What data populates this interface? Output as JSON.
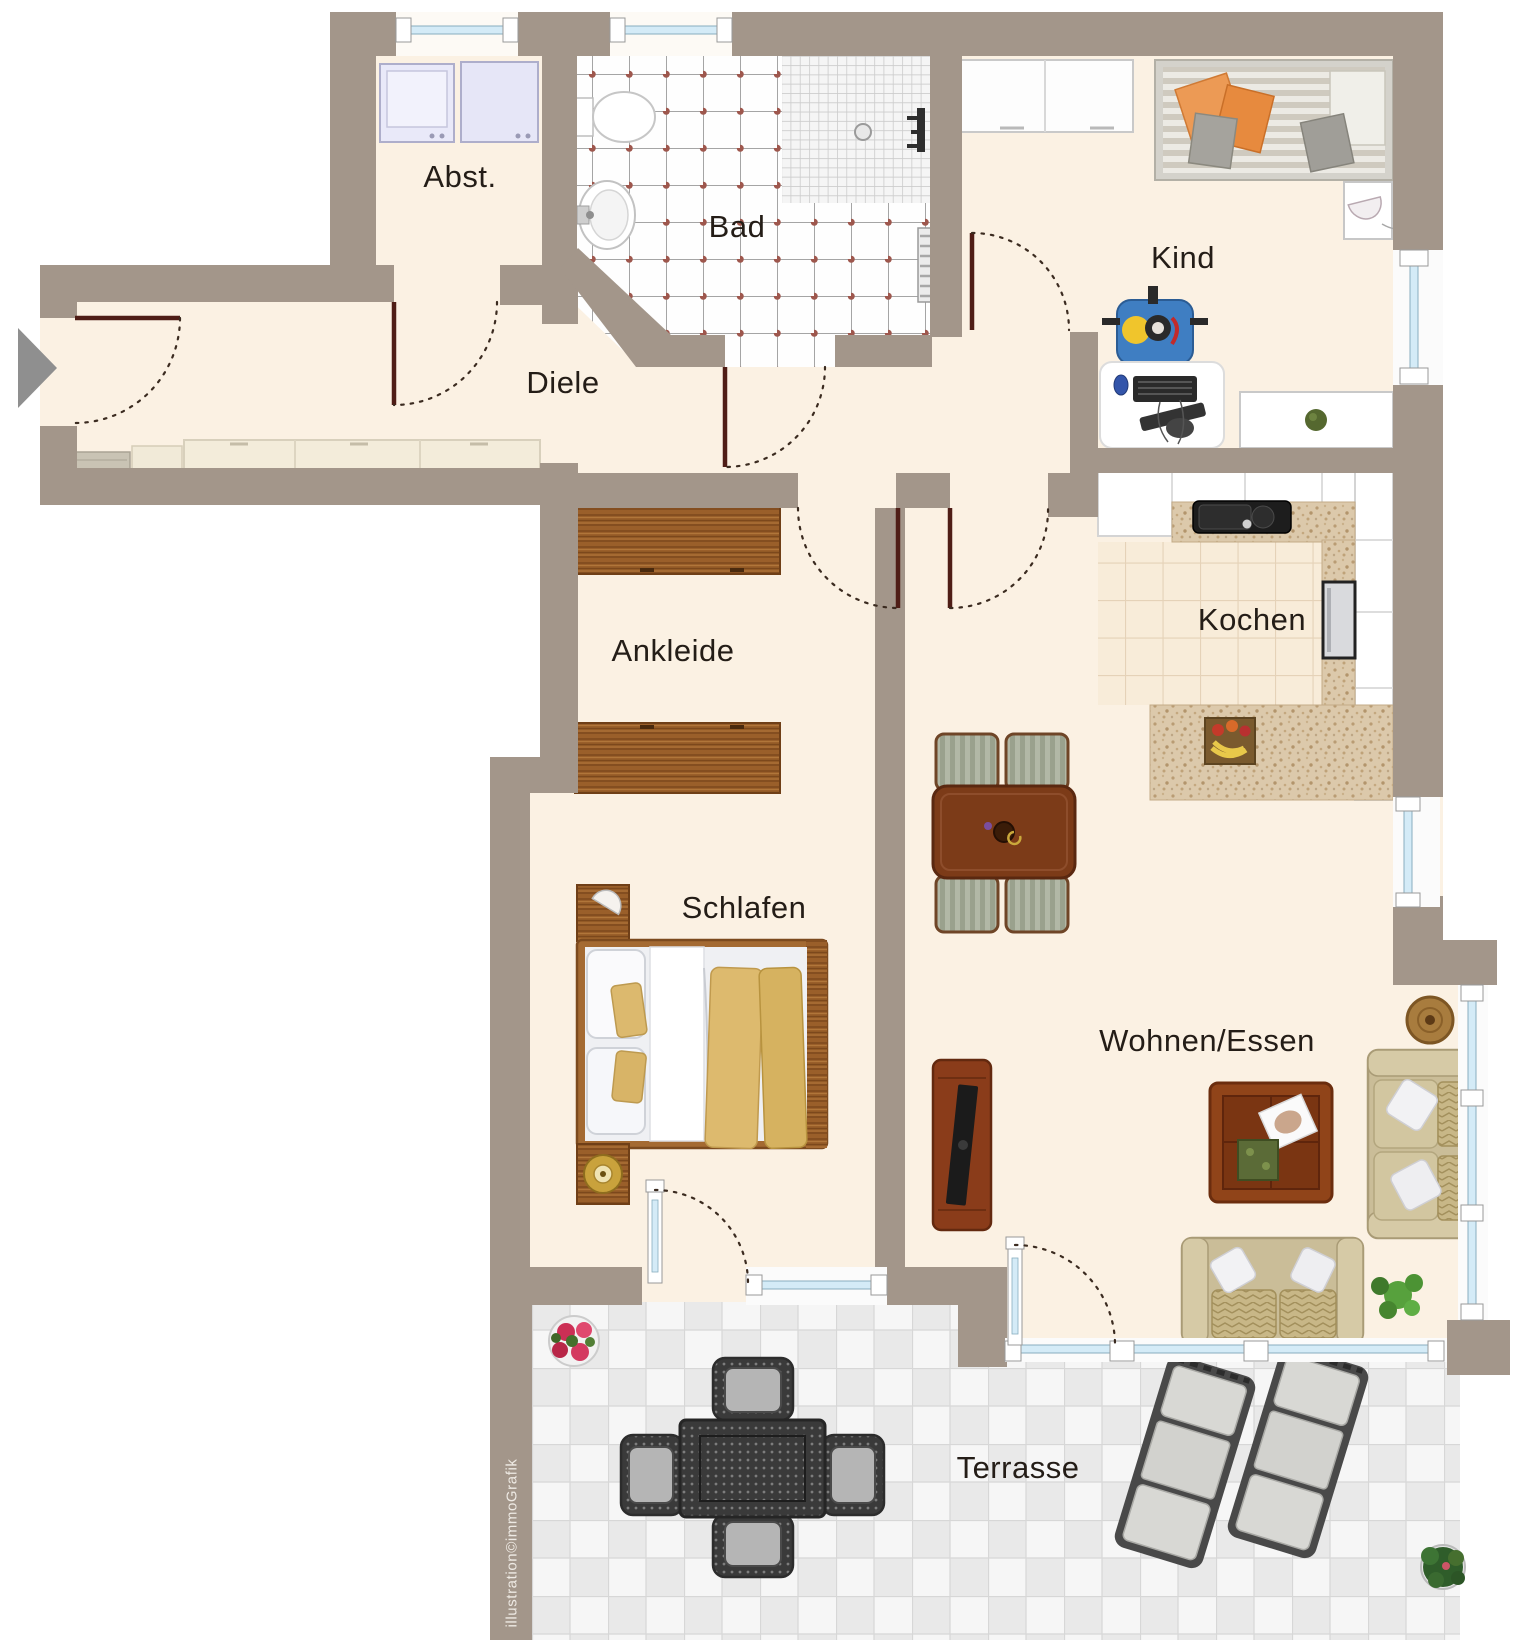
{
  "rooms": {
    "abst": "Abst.",
    "bad": "Bad",
    "kind": "Kind",
    "diele": "Diele",
    "ankleide": "Ankleide",
    "kochen": "Kochen",
    "schlafen": "Schlafen",
    "wohnen_essen": "Wohnen/Essen",
    "terrasse": "Terrasse"
  },
  "watermark": "illustration©immoGrafik",
  "colors": {
    "wall": "#a3968a",
    "floor": "#fbf1e3",
    "bath_tile_dot": "#9e574d",
    "kitchen_tile": "#f8ecd9",
    "countertop": "#dcc9ab",
    "terrace_tile": "#e9e9e9",
    "window_glass": "#d4ebf7",
    "door_leaf": "#4f1d16",
    "wood": "#9a5f2a",
    "sofa": "#cabd98"
  }
}
